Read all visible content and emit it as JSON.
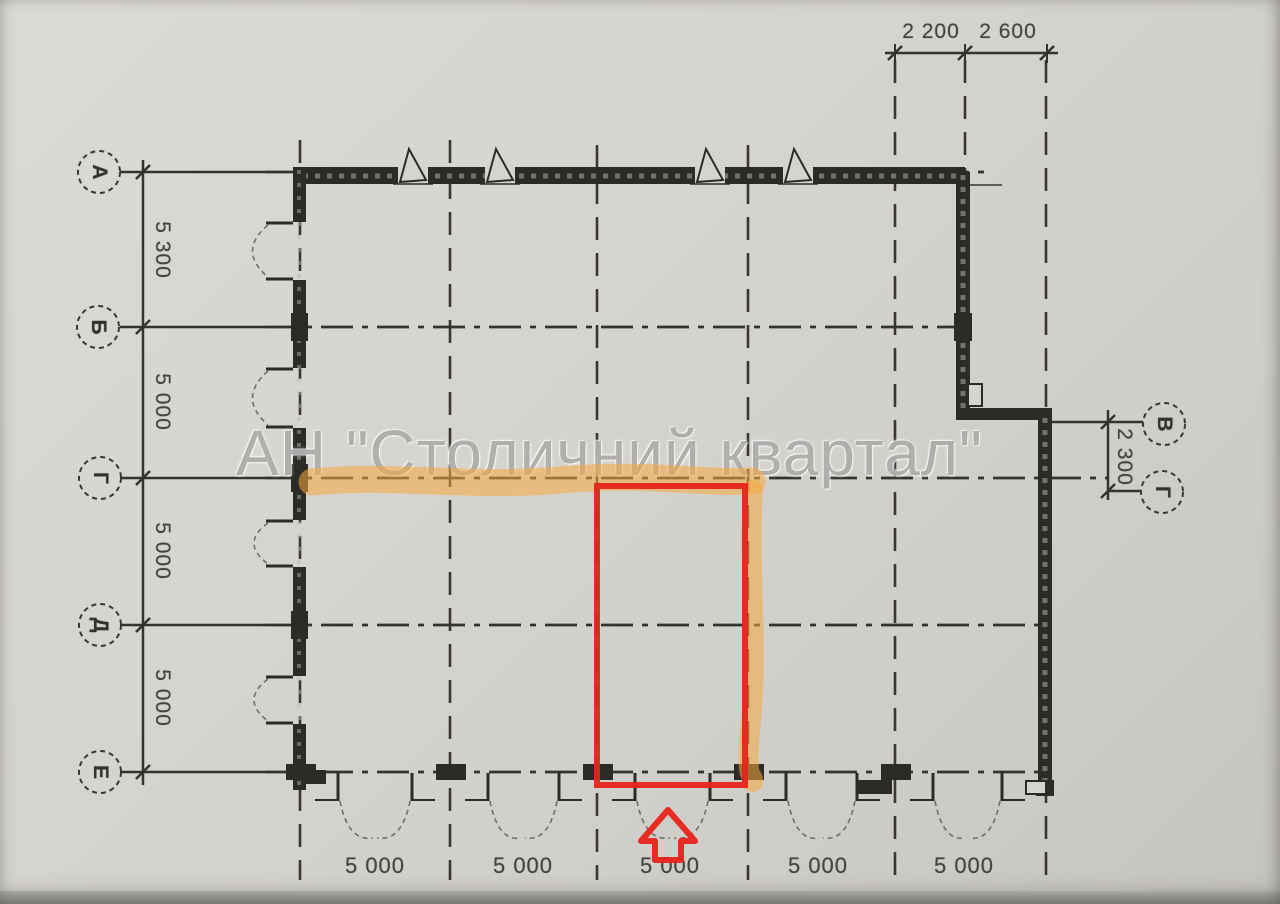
{
  "watermark": {
    "text": "АН \"Столичний квартал\""
  },
  "axes": {
    "left": [
      {
        "label": "А"
      },
      {
        "label": "Б"
      },
      {
        "label": "Г"
      },
      {
        "label": "Д"
      },
      {
        "label": "Е"
      }
    ],
    "right": [
      {
        "label": "В"
      },
      {
        "label": "Г"
      }
    ]
  },
  "dims": {
    "top": [
      {
        "value": "2 200"
      },
      {
        "value": "2 600"
      }
    ],
    "left": [
      {
        "value": "5 300"
      },
      {
        "value": "5 000"
      },
      {
        "value": "5 000"
      },
      {
        "value": "5 000"
      }
    ],
    "right": [
      {
        "value": "2 300"
      }
    ],
    "bottom": [
      {
        "value": "5 000"
      },
      {
        "value": "5 000"
      },
      {
        "value": "5 000"
      },
      {
        "value": "5 000"
      },
      {
        "value": "5 000"
      }
    ]
  },
  "colors": {
    "selection_red": "#e8231b",
    "highlighter_orange": "#f7a73e",
    "ink": "#2d2b27",
    "paper": "#d6d4cf",
    "watermark_gray": "#82807c"
  }
}
